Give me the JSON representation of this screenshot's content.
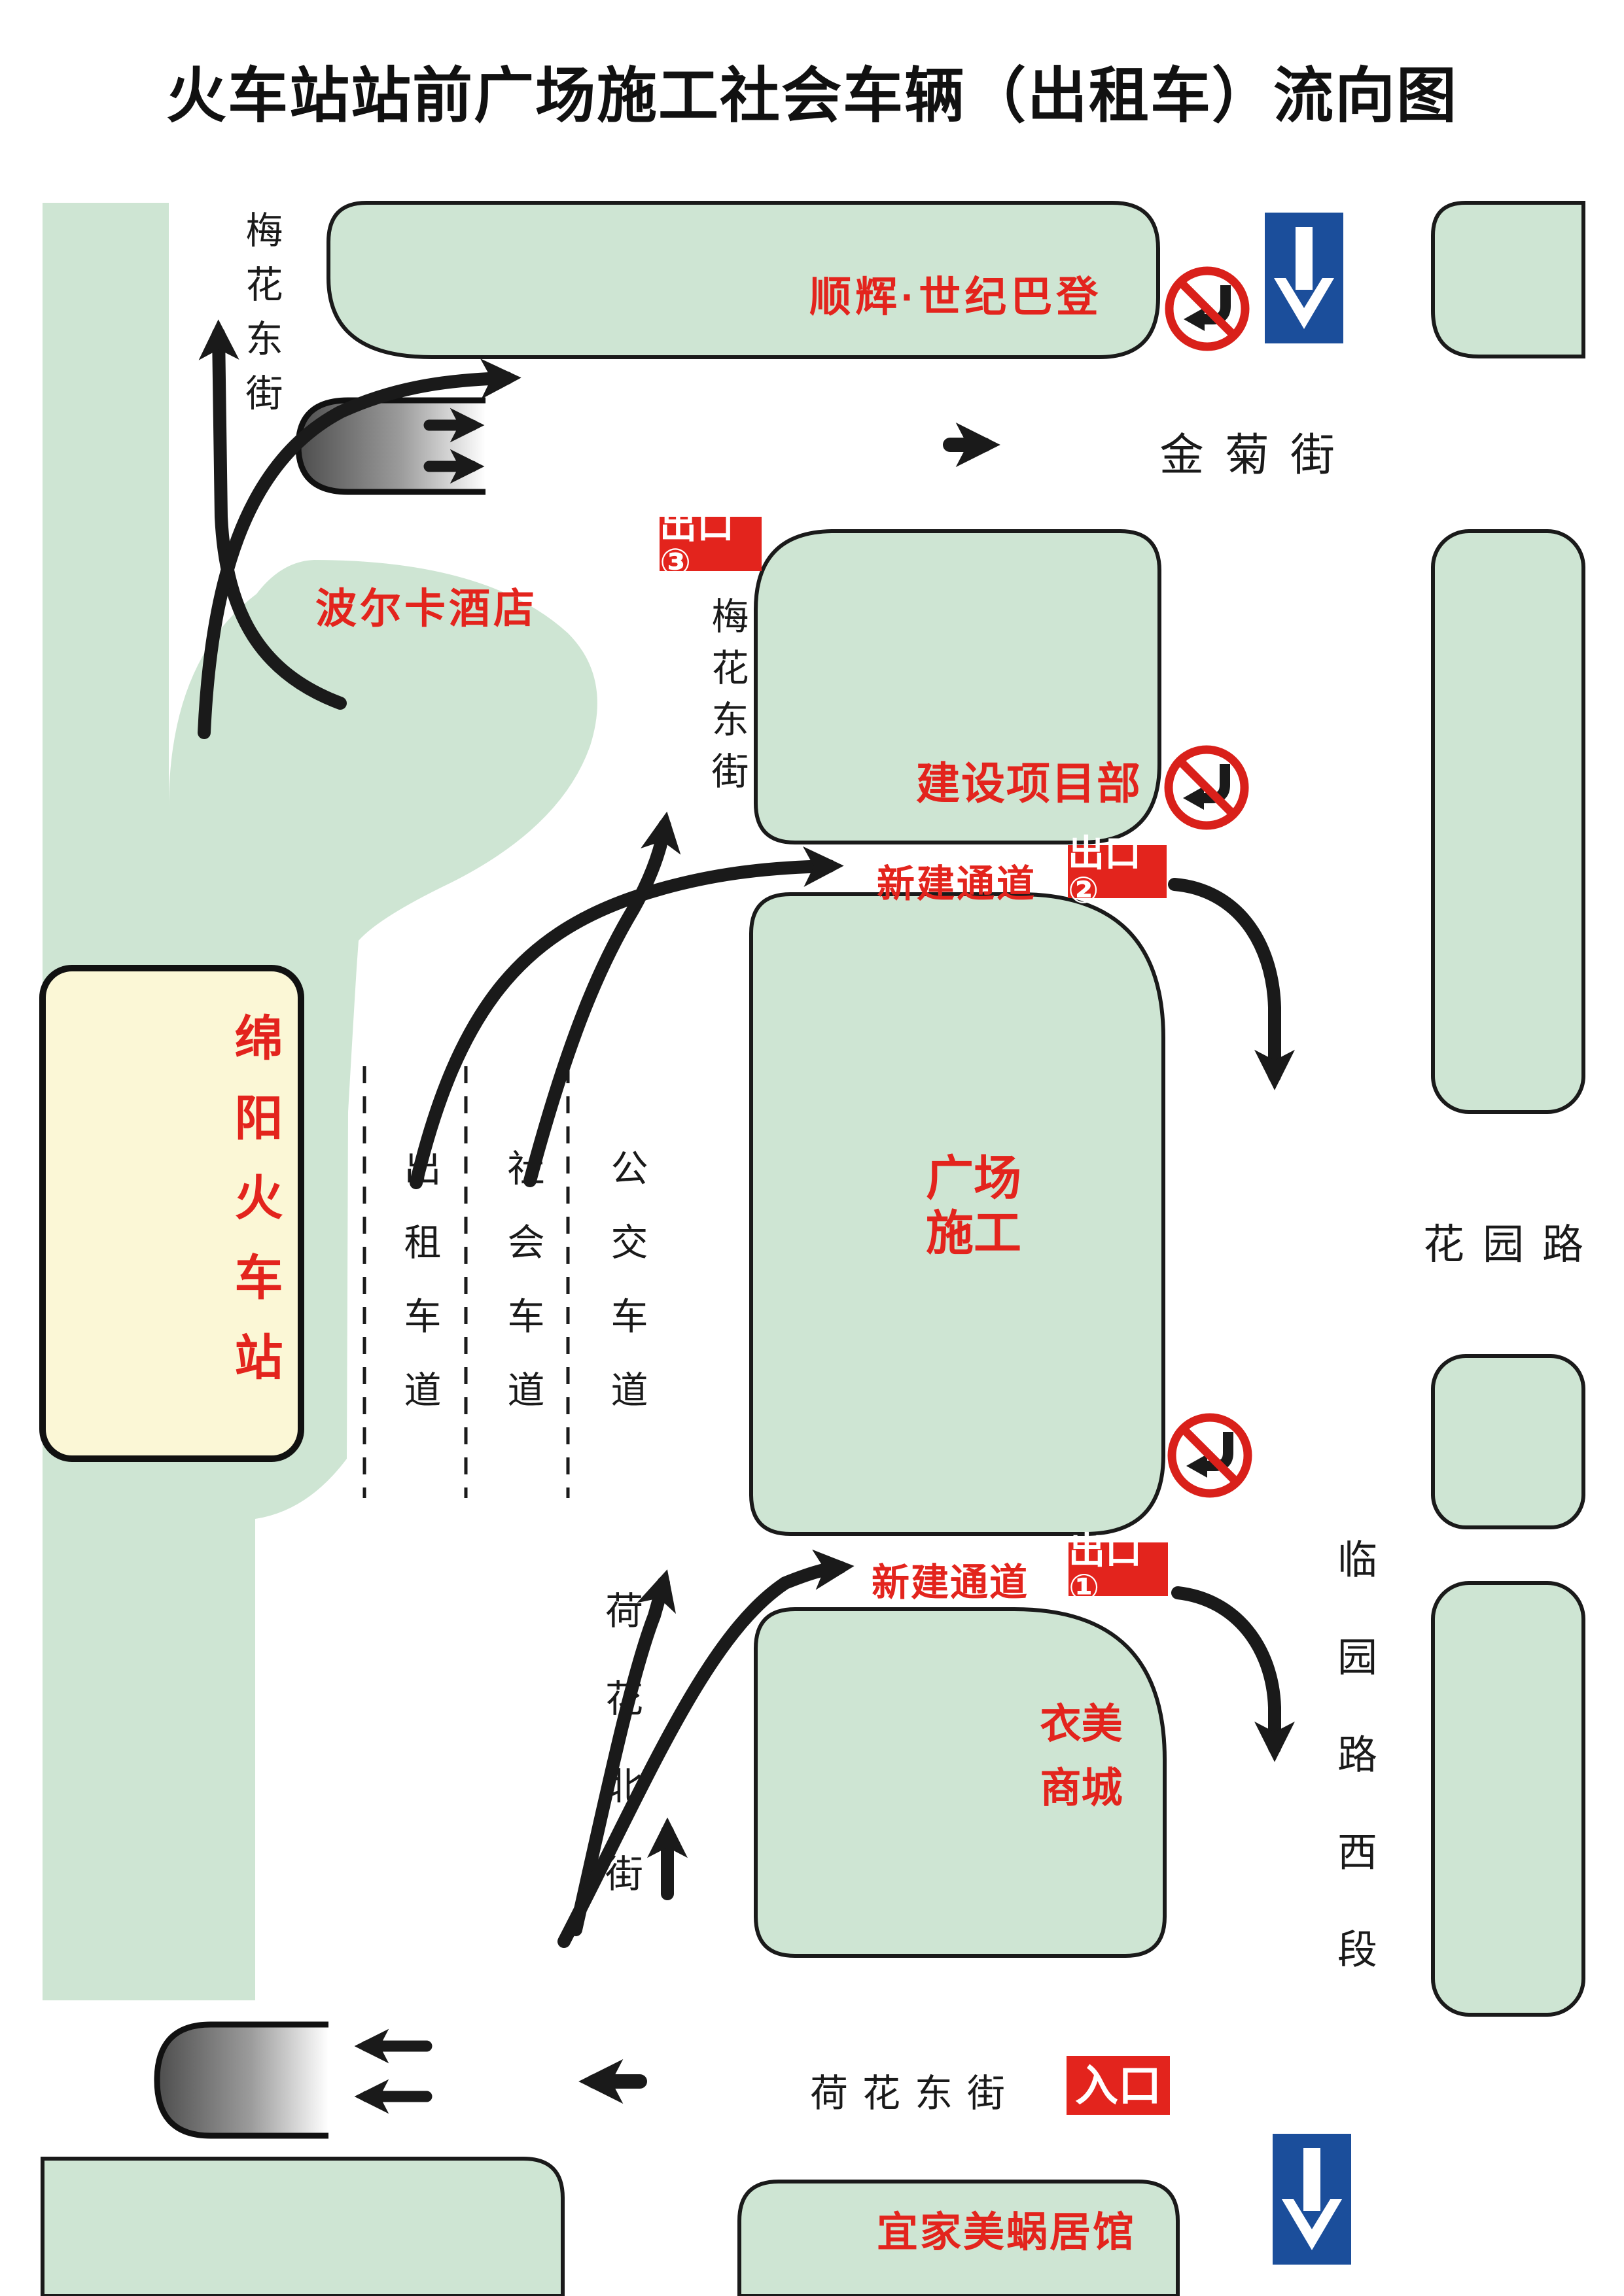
{
  "title": "火车站站前广场施工社会车辆（出租车）流向图",
  "colors": {
    "building_green": "#cee5d3",
    "station_yellow": "#fbf7d6",
    "accent_red": "#e3241d",
    "sign_blue": "#1b4e9b",
    "line_black": "#1a1a1a"
  },
  "streets": {
    "meihua_top": "梅花东街",
    "jinju": "金菊街",
    "meihua_mid": "梅花东街",
    "huayuan": "花园路",
    "linyuan_west": "临园路西段",
    "hehua_north": "荷花北街",
    "hehua_east": "荷花东街"
  },
  "buildings": {
    "shunhui": "顺辉·世纪巴登",
    "polka_hotel": "波尔卡酒店",
    "construction_office": "建设项目部",
    "square_construction": "广场\n施工",
    "railway_station": "绵阳火车站",
    "yimei_mall": "衣美\n商城",
    "bus_terminal": "汽车总站",
    "yijia_hall": "宜家美蜗居馆"
  },
  "lanes": {
    "taxi": "出租车道",
    "social": "社会车道",
    "bus": "公交车道"
  },
  "badges": {
    "exit1": "出口①",
    "exit2": "出口②",
    "exit3": "出口③",
    "entrance": "入口"
  },
  "labels": {
    "new_passage_upper": "新建通道",
    "new_passage_lower": "新建通道"
  },
  "icons": {
    "no_left_turn": "no-left-turn-sign",
    "one_way_down": "one-way-down-sign",
    "flow_arrow": "traffic-flow-arrow",
    "tunnel": "underpass-gradient"
  }
}
